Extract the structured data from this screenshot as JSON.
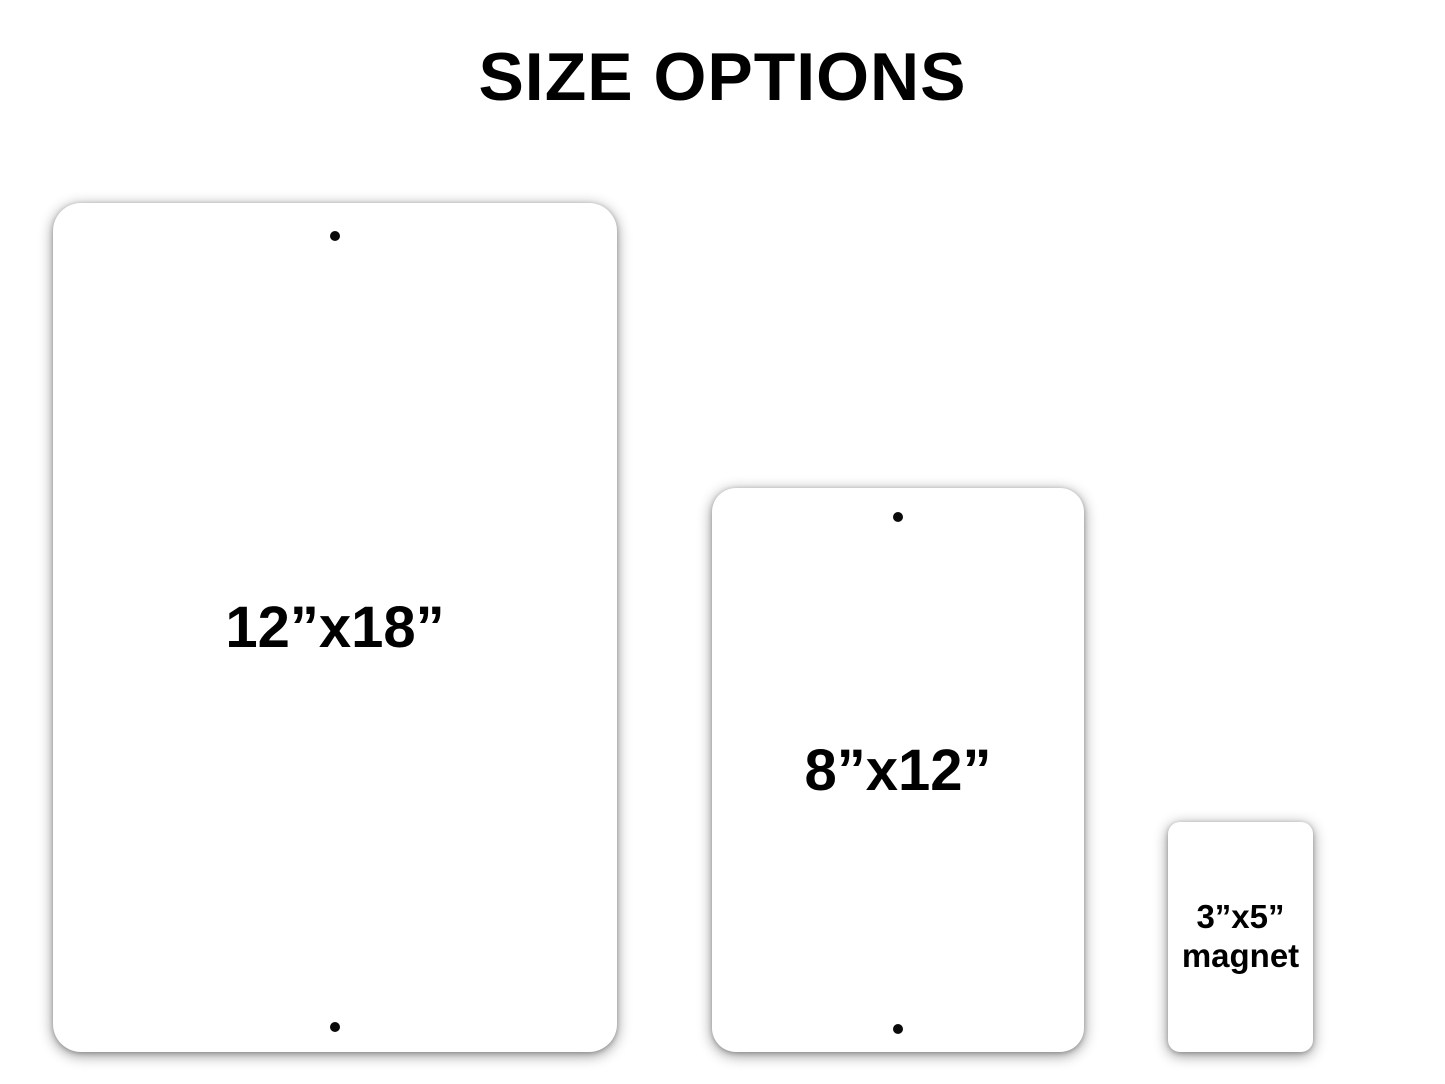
{
  "title": "SIZE OPTIONS",
  "colors": {
    "background": "#ffffff",
    "panel_fill": "#ffffff",
    "text": "#000000",
    "hole": "#0a0a0a"
  },
  "options": [
    {
      "name": "large-sign",
      "label": "12”x18”",
      "holes": 2
    },
    {
      "name": "medium-sign",
      "label": "8”x12”",
      "holes": 2
    },
    {
      "name": "magnet",
      "label_line1": "3”x5”",
      "label_line2": "magnet",
      "holes": 0
    }
  ]
}
